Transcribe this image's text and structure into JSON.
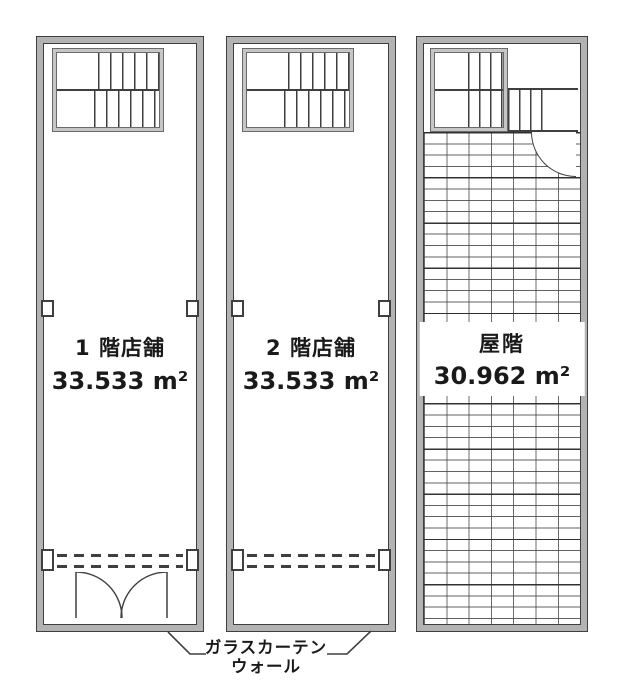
{
  "drawing_title": "tenant-floor-plans",
  "colors": {
    "line": "#3f3f3f",
    "wall_fill": "#b3b3b3",
    "stair_fill": "#c6c6c6",
    "background": "#ffffff",
    "text": "#1a1a1a"
  },
  "plans": [
    {
      "name_label": "1 階店舗",
      "area_label": "33.533 m²"
    },
    {
      "name_label": "2 階店舗",
      "area_label": "33.533 m²"
    },
    {
      "name_label": "屋階",
      "area_label": "30.962 m²"
    }
  ],
  "annotation": {
    "line1": "ガラスカーテン",
    "line2": "ウォール"
  }
}
